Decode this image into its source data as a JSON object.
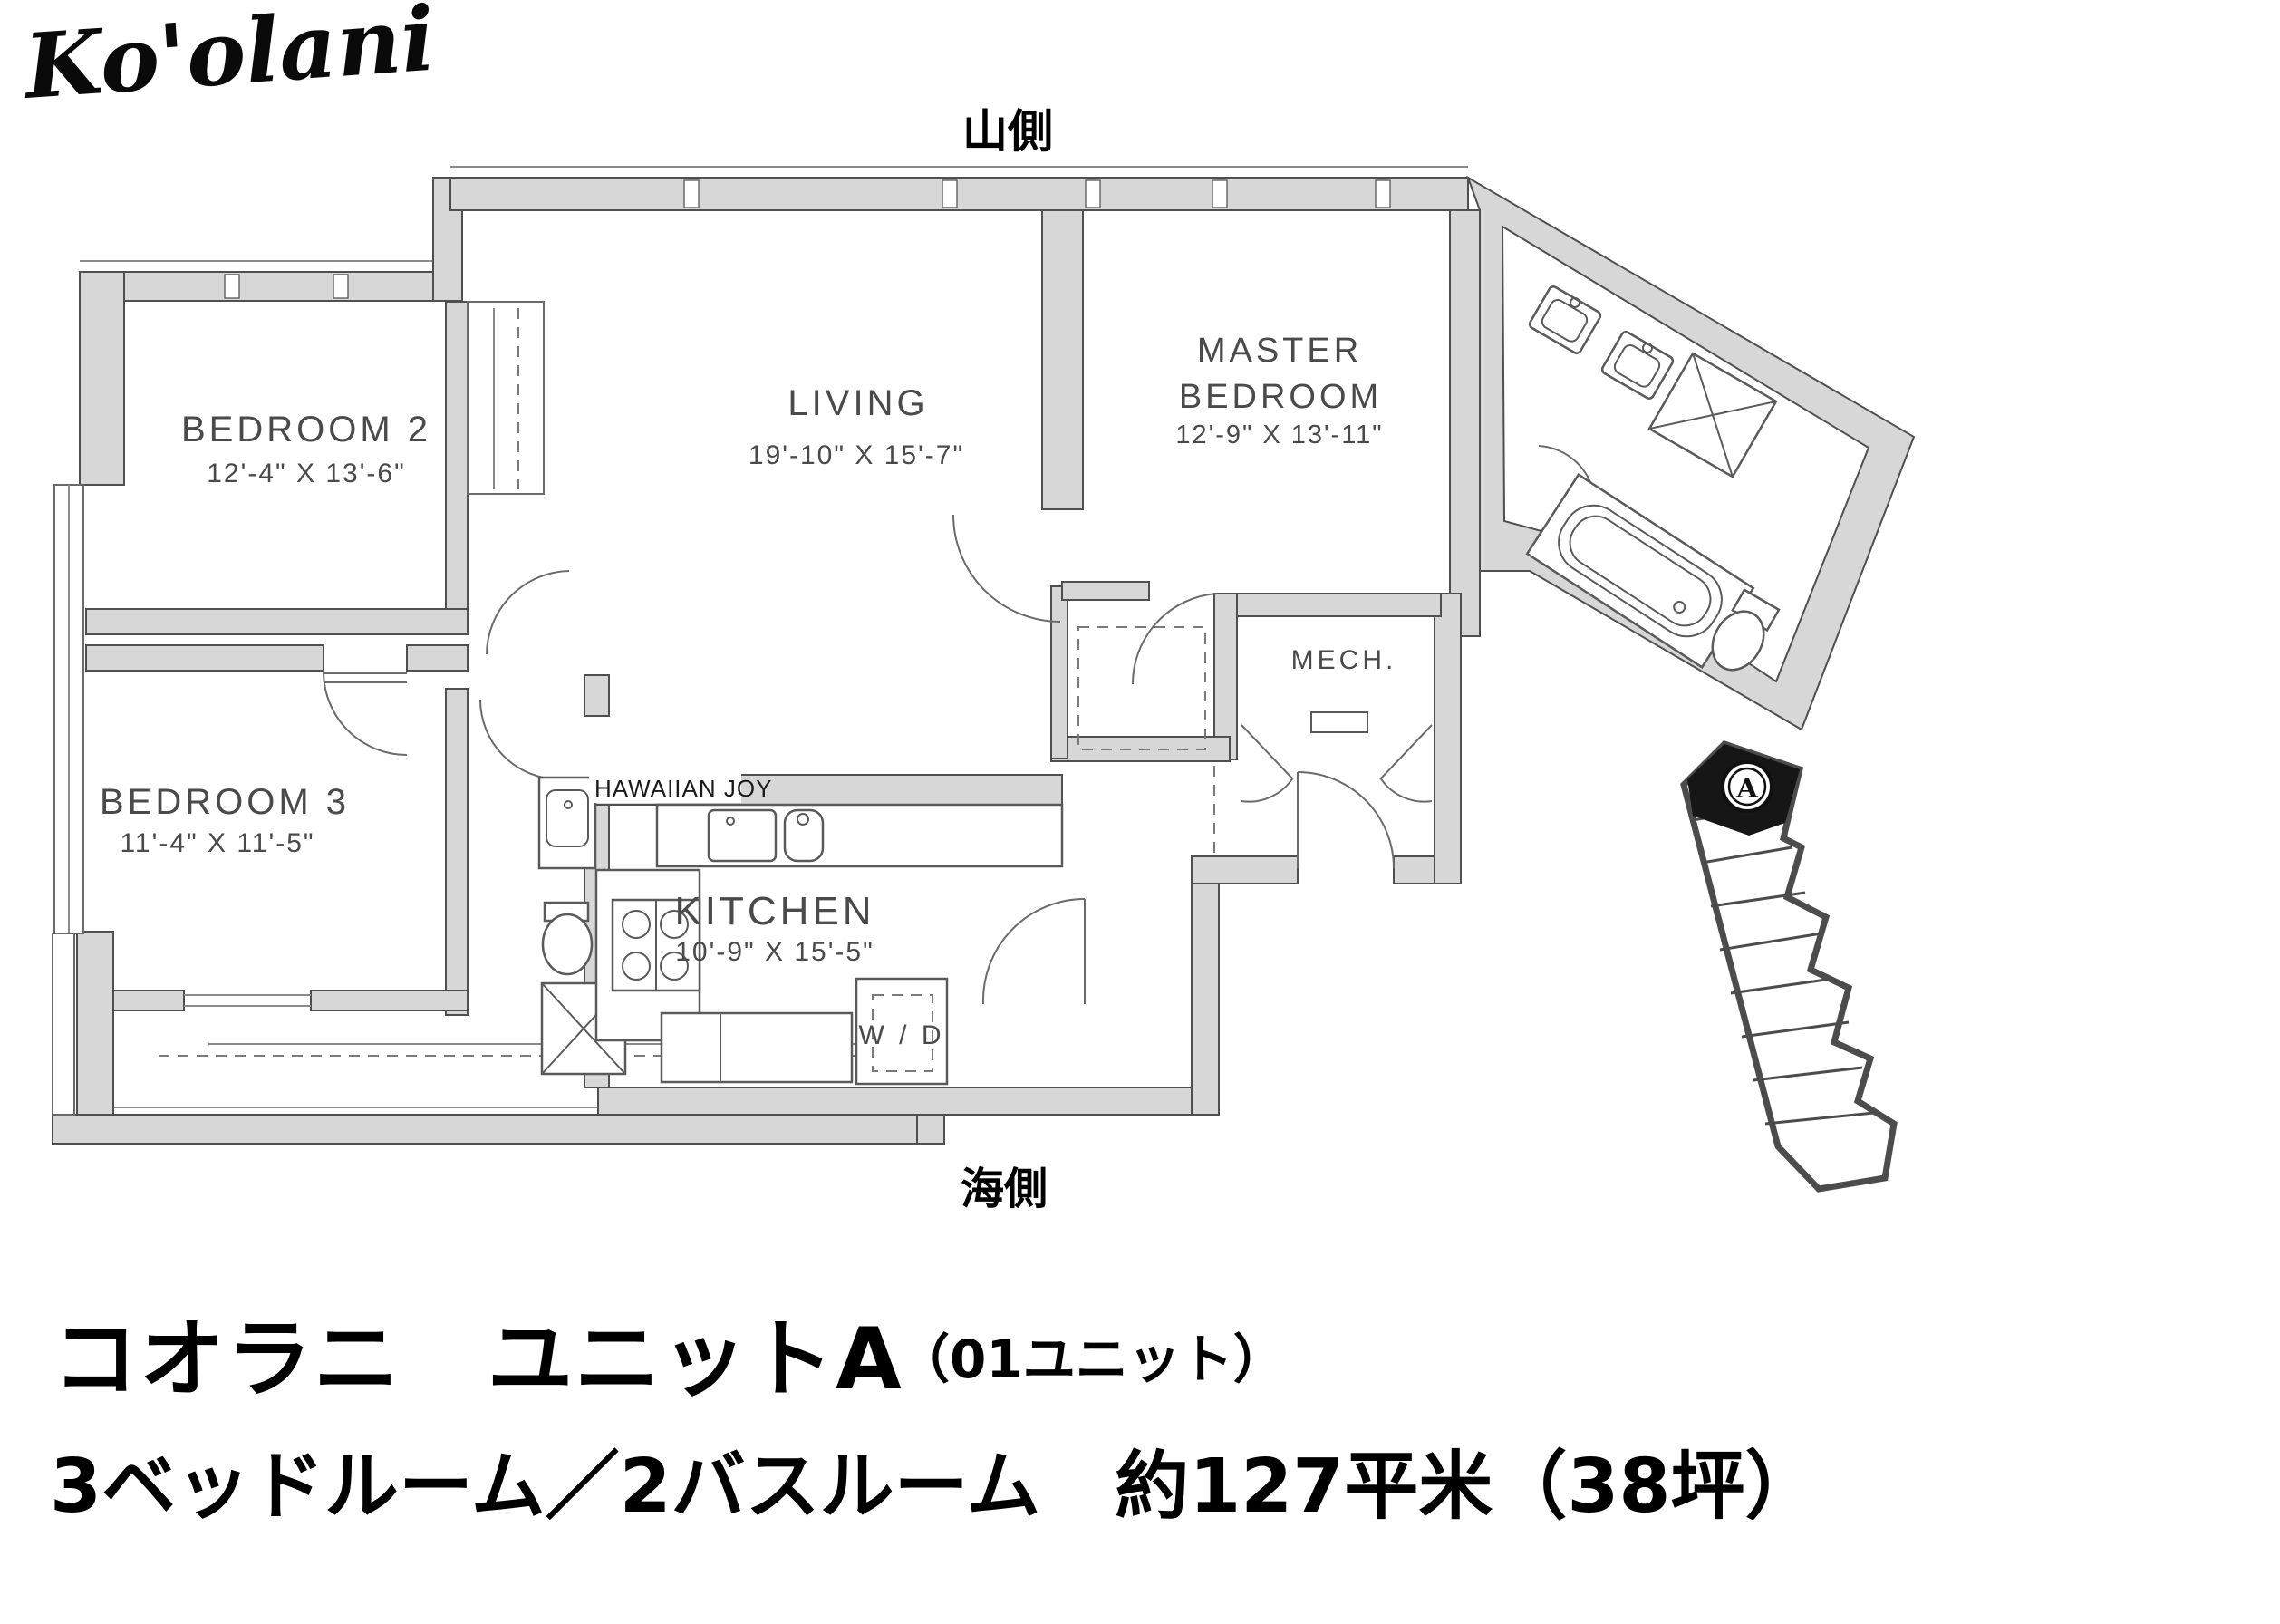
{
  "logo": {
    "text": "Ko'olani"
  },
  "orientation": {
    "top": "山側",
    "bottom": "海側"
  },
  "watermark": "HAWAIIAN JOY",
  "rooms": [
    {
      "id": "bedroom2",
      "name": "BEDROOM 2",
      "dims": "12'-4\" X 13'-6\""
    },
    {
      "id": "living",
      "name": "LIVING",
      "dims": "19'-10\" X 15'-7\""
    },
    {
      "id": "master",
      "name_line1": "MASTER",
      "name_line2": "BEDROOM",
      "dims": "12'-9\" X 13'-11\""
    },
    {
      "id": "bedroom3",
      "name": "BEDROOM 3",
      "dims": "11'-4\" X 11'-5\""
    },
    {
      "id": "kitchen",
      "name": "KITCHEN",
      "dims": "10'-9\" X 15'-5\""
    },
    {
      "id": "mech",
      "name": "MECH."
    },
    {
      "id": "laundry",
      "name": "W / D"
    }
  ],
  "keyplan": {
    "unit_marker": "A"
  },
  "title": {
    "line1_main": "コオラニ　ユニットA",
    "line1_sub": "（01ユニット）",
    "line2": "3ベッドルーム／2バスルーム　約127平米（38坪）"
  },
  "colors": {
    "wall_fill": "#d7d7d7",
    "wall_stroke": "#4f4f4f",
    "text": "#4a4a4a",
    "black": "#111111"
  }
}
